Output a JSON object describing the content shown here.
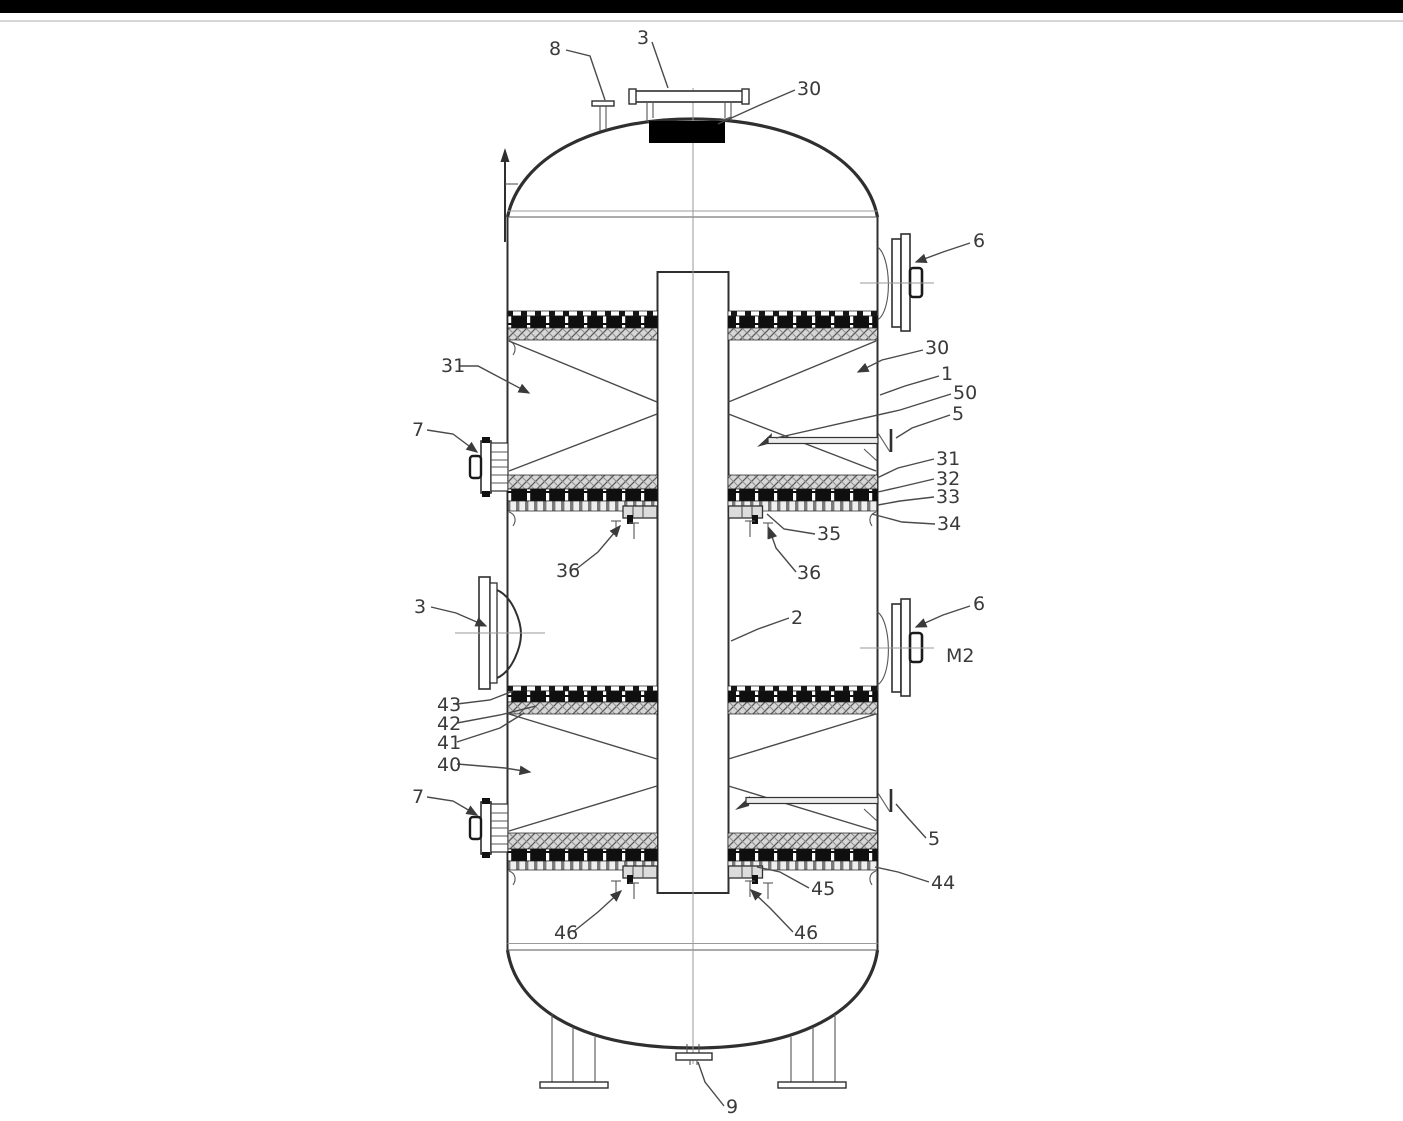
{
  "page": {
    "background": "#ffffff",
    "top_bar_color": "#000000"
  },
  "colors": {
    "line": "#2f2f2f",
    "centerline": "#9a9a9a",
    "leader": "#4a4a4a",
    "label": "#3a3a3a",
    "grate_band": "#0f0f0f",
    "packing_bg": "#d6d6d6",
    "packing_line": "#5a5a5a"
  },
  "callouts": [
    {
      "id": "vent-nozzle",
      "text": "8"
    },
    {
      "id": "manhole-top",
      "text": "3"
    },
    {
      "id": "bed-top",
      "text": "30"
    },
    {
      "id": "nozzle-6-upper",
      "text": "6"
    },
    {
      "id": "packing-section-upper",
      "text": "31"
    },
    {
      "id": "packing-bed-upper",
      "text": "30"
    },
    {
      "id": "shell",
      "text": "1"
    },
    {
      "id": "sparger-upper",
      "text": "50"
    },
    {
      "id": "inlet-upper",
      "text": "5"
    },
    {
      "id": "nozzle-7-upper",
      "text": "7"
    },
    {
      "id": "layer-31",
      "text": "31"
    },
    {
      "id": "layer-32",
      "text": "32"
    },
    {
      "id": "layer-33",
      "text": "33"
    },
    {
      "id": "cleat-34",
      "text": "34"
    },
    {
      "id": "support-35",
      "text": "35"
    },
    {
      "id": "support-36-left",
      "text": "36"
    },
    {
      "id": "support-36-right",
      "text": "36"
    },
    {
      "id": "manway-mid",
      "text": "3"
    },
    {
      "id": "downcomer",
      "text": "2"
    },
    {
      "id": "nozzle-6-lower",
      "text": "6"
    },
    {
      "id": "mark-m2",
      "text": "M2"
    },
    {
      "id": "layer-43",
      "text": "43"
    },
    {
      "id": "layer-42",
      "text": "42"
    },
    {
      "id": "layer-41",
      "text": "41"
    },
    {
      "id": "packing-section-lower",
      "text": "40"
    },
    {
      "id": "nozzle-7-lower",
      "text": "7"
    },
    {
      "id": "inlet-lower",
      "text": "5"
    },
    {
      "id": "cleat-44",
      "text": "44"
    },
    {
      "id": "support-45",
      "text": "45"
    },
    {
      "id": "support-46-left",
      "text": "46"
    },
    {
      "id": "support-46-right",
      "text": "46"
    },
    {
      "id": "drain-nozzle",
      "text": "9"
    }
  ]
}
